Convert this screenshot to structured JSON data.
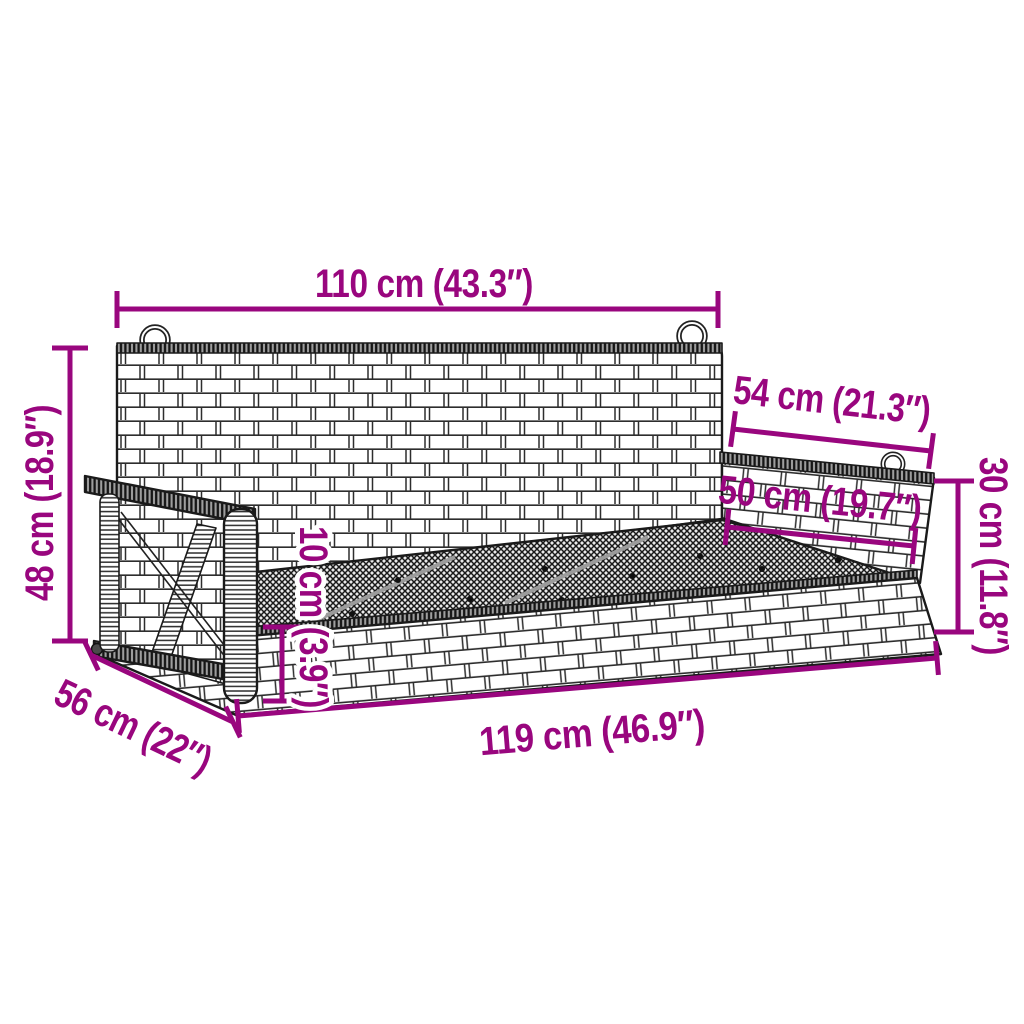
{
  "diagram": {
    "title": "Hanging swing bench dimension diagram",
    "accent_color": "#99067E",
    "outline_color": "#1a1a1a",
    "dims": {
      "top_width": "110 cm (43.3″)",
      "back_height": "48 cm (18.9″)",
      "total_depth": "56 cm (22″)",
      "total_width": "119 cm (46.9″)",
      "armrest_depth": "54 cm (21.3″)",
      "seat_depth": "50 cm (19.7″)",
      "armrest_height": "30 cm (11.8″)",
      "seat_thickness": "10 cm (3.9″)"
    }
  }
}
